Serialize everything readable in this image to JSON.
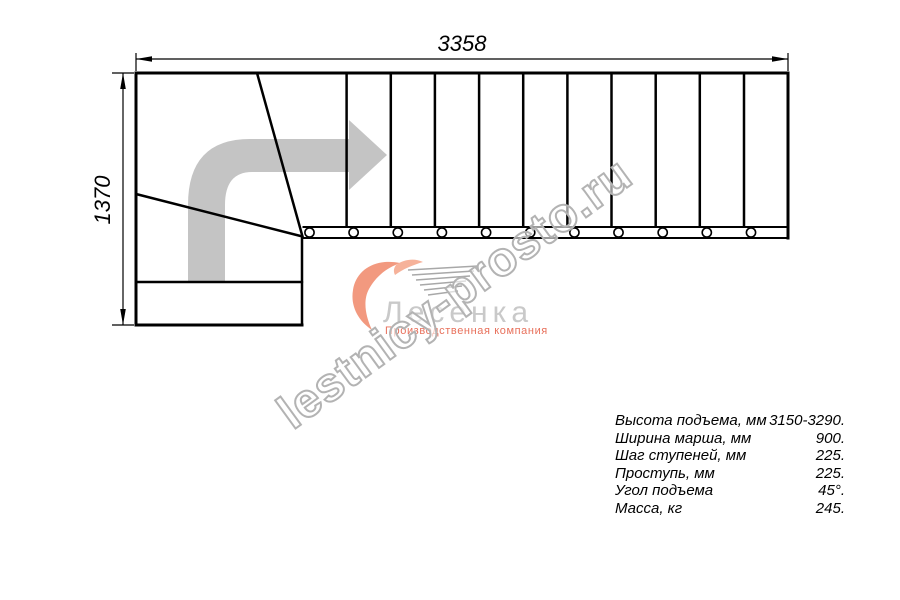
{
  "page": {
    "background": "#ffffff"
  },
  "drawing": {
    "type": "staircase-plan-top-view",
    "description": "L-shaped staircase plan with winder turn, 11 straight treads with baluster circles, gray direction arrow turning right",
    "tread_count": 11,
    "line_color": "#000000",
    "arrow_color": "#c4c4c4"
  },
  "dimensions": {
    "width_label": "3358",
    "height_label": "1370"
  },
  "watermark": {
    "text": "lestnicy-prosto.ru",
    "stroke_color": "#b3b3b3"
  },
  "logo": {
    "name": "Лесенка",
    "tagline": "Производственная компания",
    "mark_color": "#f2997f",
    "name_color": "#c9c9c9",
    "tagline_color": "#e8705b"
  },
  "specs": {
    "rows": [
      {
        "label": "Высота подъема, мм",
        "value": "3150-3290."
      },
      {
        "label": "Ширина марша, мм",
        "value": "900."
      },
      {
        "label": "Шаг ступеней, мм",
        "value": "225."
      },
      {
        "label": "Проступь, мм",
        "value": "225."
      },
      {
        "label": "Угол подъема",
        "value": "45°."
      },
      {
        "label": "Масса, кг",
        "value": "245."
      }
    ]
  }
}
